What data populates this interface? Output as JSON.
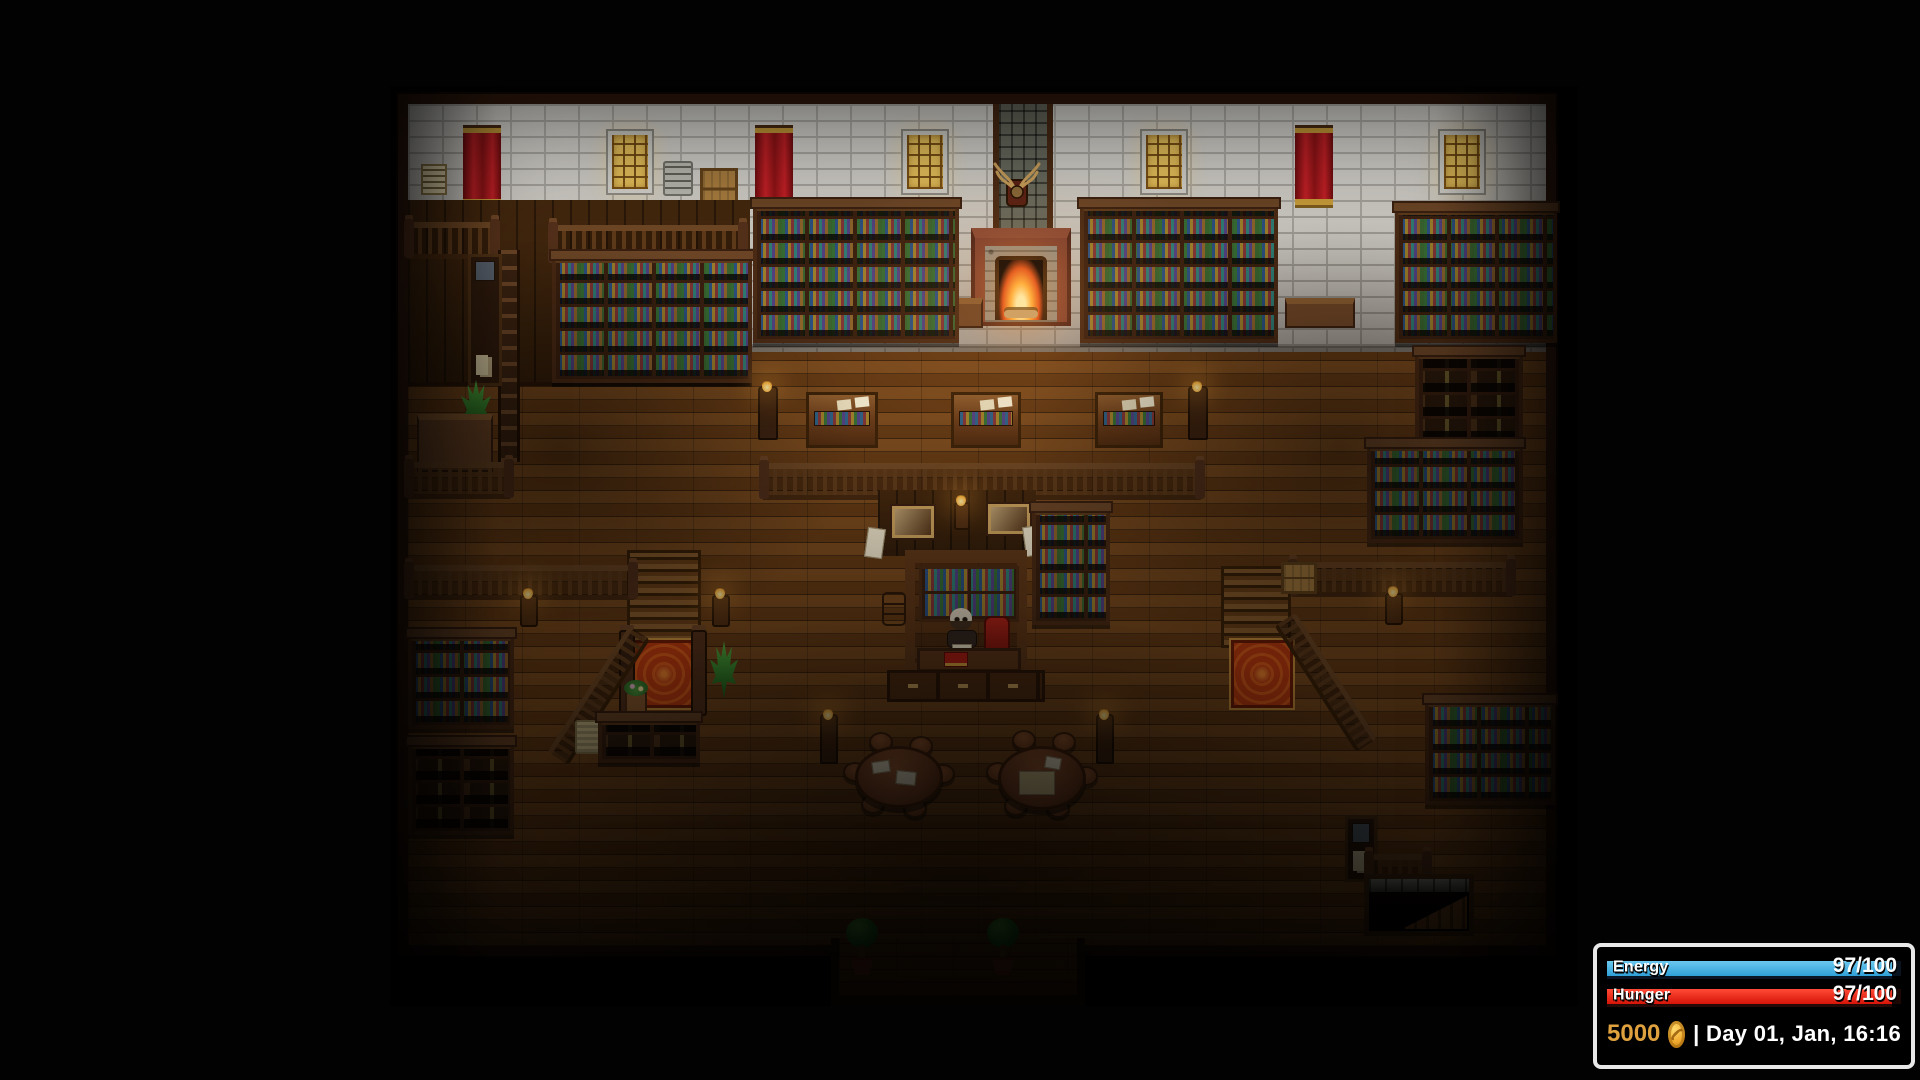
{
  "hud": {
    "energy": {
      "label": "Energy",
      "value": "97/100",
      "percent": 97
    },
    "hunger": {
      "label": "Hunger",
      "value": "97/100",
      "percent": 97
    },
    "money": {
      "amount": "5000"
    },
    "datetime": {
      "separator": "|",
      "text": "Day 01, Jan, 16:16"
    }
  },
  "colors": {
    "energy_bar": "#2f9fd8",
    "hunger_bar": "#d61408",
    "coin_gold": "#f0a92f",
    "money_text": "#dfa13d",
    "banner_red": "#bf1d22",
    "window_amber": "#e9c35c",
    "carpet_red": "#bf3b0f",
    "fire_glow": "#ffae3c",
    "wall_brick": "#d9d7d0",
    "floor_wood": "#6e3f16",
    "shelf_wood": "#4a2a14"
  }
}
